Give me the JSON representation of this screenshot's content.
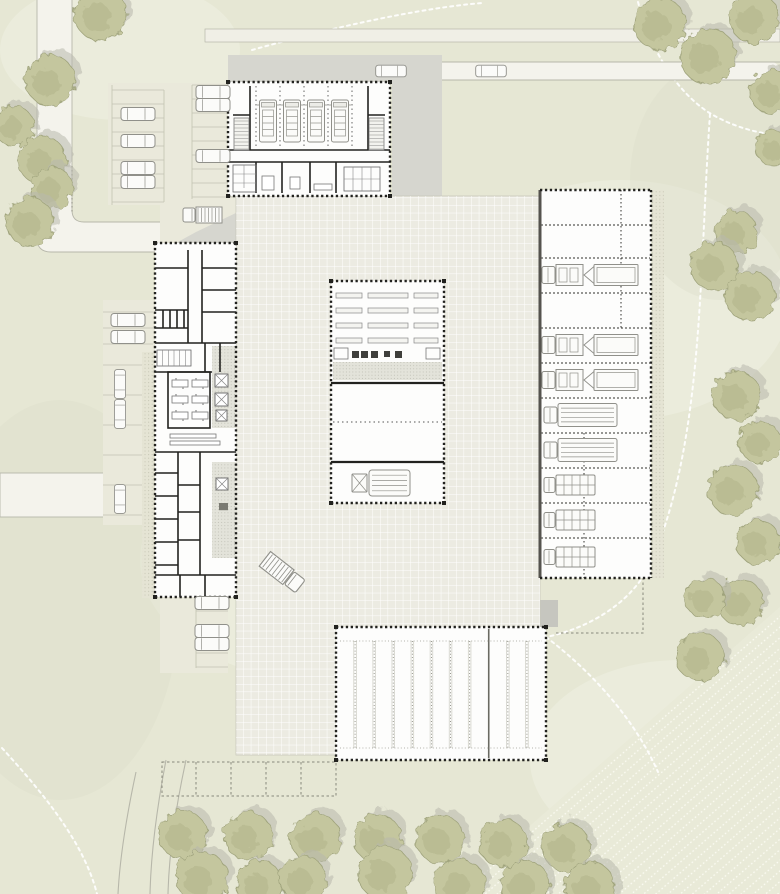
{
  "palette": {
    "grass": "#e6e7d4",
    "grass_light": "#eff0e1",
    "grass_dark": "#dcdecb",
    "field": "#e9ead8",
    "field_line": "#fbfbf2",
    "road": "#f4f3ec",
    "road_edge": "#b7b7aa",
    "top_band": "#f0efe6",
    "apron": "#d6d6cf",
    "shadow": "#c6c6bf",
    "courtyard": "#ecebe2",
    "grid_line": "#ffffff",
    "courtyard_edge": "#c8c8bb",
    "parking": "#eae9db",
    "stall_line": "#c2c2b2",
    "paver": "#e5e4d4",
    "paver_dot": "#c6c6b4",
    "building": "#fdfdfc",
    "wall": "#22221f",
    "wall_gray": "#55534e",
    "light_wall": "#d2d2c9",
    "hatch_floor": "#e3e3da",
    "hatch_dot": "#b5b5aa",
    "vehicle_stroke": "#90908a",
    "vehicle_fill": "#fbfbf9",
    "vehicle_detail": "#c9c9c2",
    "tree": "#c4c69e",
    "tree_dark": "#aeb187",
    "tree_edge": "#9fa37c",
    "tree_shadow": "#b9b9ad",
    "trail": "#ffffff",
    "dash_dark": "#88887c",
    "equip": "#3f3f3b"
  },
  "site": {
    "canvas": {
      "w": 780,
      "h": 894
    },
    "grass_patches_light": [
      [
        620,
        300,
        170,
        120
      ],
      [
        320,
        560,
        180,
        120
      ],
      [
        120,
        50,
        120,
        70
      ],
      [
        680,
        760,
        150,
        100
      ]
    ],
    "grass_patches_dark": [
      [
        60,
        600,
        120,
        200
      ],
      [
        720,
        180,
        90,
        120
      ]
    ],
    "roads": {
      "vertical_fill": "M37,0 L37,238 Q37,252 51,252 L162,252 L162,222 L84,222 Q72,222 72,210 L72,0 Z",
      "vertical_edges": [
        "M37,0 L37,238 Q37,252 51,252 L162,252",
        "M72,0 L72,210 Q72,222 84,222 L162,222"
      ],
      "curb_dots": "M72,166 L72,212",
      "top_band": [
        205,
        29,
        575,
        13
      ],
      "left_band": [
        0,
        473,
        112,
        44
      ],
      "lane": [
        358,
        62,
        422,
        18
      ],
      "lane_edges": [
        "M368,62 H780",
        "M368,80 H780",
        "M368,62 Q358,62 358,71 Q358,80 368,80"
      ],
      "curves": [
        "M166,760 C158,802 151,850 150,894",
        "M186,760 C176,806 169,852 168,894",
        "M136,772 C127,814 120,854 118,894"
      ]
    },
    "trails": [
      "M252,50 C330,28 420,8 482,3",
      "M638,2 C652,54 678,92 708,112 C732,127 760,134 780,135",
      "M710,114 C699,272 704,432 654,556",
      "M654,556 C634,606 582,630 546,637",
      "M546,637 C592,672 634,718 658,772",
      "M2,748 C42,792 84,842 97,894"
    ],
    "field_poly": "M452,894 L780,607 L780,894 Z",
    "trees": [
      [
        100,
        14,
        26
      ],
      [
        50,
        80,
        25
      ],
      [
        14,
        126,
        20
      ],
      [
        42,
        160,
        24
      ],
      [
        52,
        188,
        21
      ],
      [
        30,
        222,
        24
      ],
      [
        660,
        24,
        26
      ],
      [
        708,
        56,
        28
      ],
      [
        754,
        18,
        25
      ],
      [
        772,
        92,
        22
      ],
      [
        774,
        148,
        18
      ],
      [
        736,
        232,
        21
      ],
      [
        714,
        266,
        24
      ],
      [
        750,
        296,
        25
      ],
      [
        737,
        396,
        24
      ],
      [
        760,
        442,
        21
      ],
      [
        733,
        490,
        25
      ],
      [
        758,
        542,
        22
      ],
      [
        740,
        602,
        23
      ],
      [
        705,
        598,
        20
      ],
      [
        700,
        657,
        24
      ],
      [
        183,
        835,
        24
      ],
      [
        248,
        836,
        24
      ],
      [
        315,
        838,
        25
      ],
      [
        377,
        838,
        24
      ],
      [
        440,
        839,
        24
      ],
      [
        503,
        843,
        24
      ],
      [
        566,
        847,
        24
      ],
      [
        202,
        878,
        26
      ],
      [
        260,
        884,
        23
      ],
      [
        303,
        879,
        23
      ],
      [
        385,
        873,
        27
      ],
      [
        460,
        884,
        25
      ],
      [
        525,
        884,
        24
      ],
      [
        590,
        887,
        25
      ]
    ],
    "markings": {
      "dashed_stalls_outline": [
        162,
        762,
        174,
        34
      ],
      "dashed_stalls_verticals": [
        196,
        231,
        266,
        301
      ],
      "reserved": "M556,633 H643 V578"
    }
  },
  "parking": {
    "lotA": {
      "poly": "M108,83 H238 V243 H160 V205 H108 Z",
      "vlines": [
        [
          112,
          85,
          112,
          205
        ],
        [
          164,
          90,
          164,
          202
        ],
        [
          192,
          85,
          192,
          199
        ]
      ],
      "hlines_left": [
        90,
        104,
        118,
        132,
        146,
        160,
        174,
        188,
        202
      ],
      "hlines_right": [
        85,
        99,
        113,
        127,
        141,
        155,
        169,
        183,
        197
      ]
    },
    "lotB": {
      "poly": "M103,300 H155 V352 H142 V525 H103 Z",
      "hlines_top": [
        312,
        328,
        344
      ],
      "hlines": [
        365,
        395,
        425,
        455,
        485,
        515
      ]
    },
    "lotC": {
      "rect": [
        160,
        597,
        68,
        76
      ],
      "vline": [
        196,
        597,
        196,
        668
      ],
      "hlines": [
        597,
        611,
        625,
        639,
        653,
        667
      ]
    },
    "paver_strips": [
      [
        142,
        352,
        13,
        246
      ],
      [
        652,
        190,
        12,
        388
      ]
    ]
  },
  "aprons": {
    "north": "M228,55 H442 V197 H392 V82 H228 Z",
    "wedge": "M196,232 L238,212 L238,243 L176,243 Z",
    "canopy_shadow": "M345,627 L398,600 L558,600 L558,627 Z"
  },
  "courtyard": {
    "rect": [
      236,
      196,
      304,
      559
    ]
  },
  "buildings": {
    "hall": {
      "rect": [
        228,
        82,
        162,
        114
      ],
      "bays_dashed_x": [
        256,
        280,
        304,
        328,
        352
      ],
      "bay_top": 86,
      "bay_bottom": 149,
      "walls": [
        [
          250,
          86,
          250,
          150
        ],
        [
          233,
          115,
          250,
          115
        ],
        [
          368,
          86,
          368,
          150
        ],
        [
          368,
          115,
          385,
          115
        ],
        [
          228,
          150,
          390,
          150
        ],
        [
          228,
          162,
          390,
          162
        ],
        [
          256,
          162,
          256,
          193
        ],
        [
          282,
          162,
          282,
          193
        ],
        [
          310,
          162,
          310,
          193
        ],
        [
          336,
          162,
          336,
          193
        ]
      ],
      "stairs": [
        [
          234,
          118,
          15,
          32
        ],
        [
          369,
          118,
          15,
          32
        ]
      ],
      "closet": [
        233,
        165,
        23,
        27
      ],
      "lockers": [
        344,
        167,
        36,
        24
      ],
      "tables": [
        [
          262,
          176,
          12,
          14
        ],
        [
          290,
          177,
          10,
          12
        ],
        [
          314,
          184,
          18,
          6
        ]
      ],
      "trucks_cx": [
        268,
        292,
        316,
        340
      ],
      "trucks_cy": 121
    },
    "wing": {
      "rect": [
        155,
        243,
        81,
        354
      ],
      "walls": [
        [
          188,
          250,
          188,
          343
        ],
        [
          202,
          250,
          202,
          343
        ],
        [
          155,
          268,
          188,
          268
        ],
        [
          155,
          310,
          188,
          310
        ],
        [
          163,
          310,
          163,
          328
        ],
        [
          170,
          310,
          170,
          328
        ],
        [
          177,
          310,
          177,
          328
        ],
        [
          184,
          310,
          184,
          328
        ],
        [
          155,
          328,
          188,
          328
        ],
        [
          202,
          268,
          236,
          268
        ],
        [
          202,
          290,
          236,
          290
        ],
        [
          202,
          312,
          236,
          312
        ],
        [
          155,
          343,
          236,
          343
        ],
        [
          205,
          343,
          205,
          372
        ],
        [
          220,
          343,
          220,
          372
        ],
        [
          155,
          372,
          212,
          372
        ],
        [
          155,
          452,
          236,
          452
        ],
        [
          178,
          452,
          178,
          575
        ],
        [
          200,
          452,
          200,
          575
        ],
        [
          155,
          473,
          178,
          473
        ],
        [
          155,
          496,
          178,
          496
        ],
        [
          155,
          519,
          178,
          519
        ],
        [
          155,
          542,
          178,
          542
        ],
        [
          155,
          565,
          178,
          565
        ],
        [
          178,
          485,
          200,
          485
        ],
        [
          178,
          512,
          200,
          512
        ],
        [
          178,
          540,
          200,
          540
        ],
        [
          155,
          575,
          236,
          575
        ],
        [
          180,
          575,
          180,
          597
        ],
        [
          205,
          575,
          205,
          597
        ]
      ],
      "meeting_room": [
        168,
        372,
        42,
        56
      ],
      "tables": [
        [
          172,
          380,
          16,
          7
        ],
        [
          192,
          380,
          16,
          7
        ],
        [
          172,
          396,
          16,
          7
        ],
        [
          192,
          396,
          16,
          7
        ],
        [
          172,
          412,
          16,
          7
        ],
        [
          192,
          412,
          16,
          7
        ]
      ],
      "lockers": [
        157,
        350,
        34,
        16
      ],
      "benches": [
        [
          170,
          434,
          46,
          4
        ],
        [
          170,
          441,
          50,
          4
        ]
      ],
      "hatch_rects": [
        [
          212,
          346,
          24,
          82
        ],
        [
          212,
          462,
          24,
          96
        ]
      ],
      "fixtures": [
        [
          215,
          374,
          13
        ],
        [
          215,
          393,
          13
        ],
        [
          216,
          410,
          11
        ],
        [
          216,
          478,
          12
        ]
      ],
      "sink": [
        219,
        503,
        9
      ]
    },
    "workshop": {
      "rect": [
        331,
        281,
        113,
        222
      ],
      "solid_walls": [
        [
          331,
          383,
          444,
          383
        ],
        [
          331,
          462,
          444,
          462
        ]
      ],
      "shelf_rows": [
        293,
        308,
        323,
        338
      ],
      "shelf_cols": [
        [
          336,
          26
        ],
        [
          368,
          40
        ],
        [
          414,
          24
        ]
      ],
      "equip": [
        [
          352,
          351,
          7
        ],
        [
          361,
          351,
          7
        ],
        [
          371,
          351,
          7
        ],
        [
          384,
          351,
          6
        ],
        [
          395,
          351,
          7
        ]
      ],
      "benches": [
        [
          334,
          348,
          14,
          11
        ],
        [
          426,
          348,
          14,
          11
        ]
      ],
      "hatch": [
        333,
        362,
        109,
        18
      ],
      "dashed_lines": [
        [
          333,
          422,
          442,
          422
        ]
      ],
      "truck": [
        381,
        483
      ]
    },
    "garage": {
      "rect": [
        540,
        190,
        111,
        388
      ],
      "dividers_y": [
        225,
        258,
        293,
        328,
        363,
        398,
        433,
        468,
        503,
        538
      ],
      "vdash": [
        [
          621,
          190,
          621,
          328
        ],
        [
          584,
          433,
          584,
          578
        ]
      ],
      "bays": [
        {
          "cy": 275,
          "type": "ttrailer"
        },
        {
          "cy": 345,
          "type": "ttrailer"
        },
        {
          "cy": 380,
          "type": "ttrailer"
        },
        {
          "cy": 415,
          "type": "boxtruck"
        },
        {
          "cy": 450,
          "type": "boxtruck"
        },
        {
          "cy": 485,
          "type": "van"
        },
        {
          "cy": 520,
          "type": "van"
        },
        {
          "cy": 557,
          "type": "van"
        }
      ]
    },
    "canopy": {
      "rect": [
        336,
        627,
        210,
        133
      ],
      "stalls": 11,
      "solid_divider_index": 8,
      "stripe_top": 641,
      "stripe_bottom": 748
    }
  },
  "vehicles": [
    {
      "type": "car",
      "x": 138,
      "y": 114,
      "rot": 0
    },
    {
      "type": "car",
      "x": 138,
      "y": 141,
      "rot": 0
    },
    {
      "type": "car",
      "x": 138,
      "y": 168,
      "rot": 0
    },
    {
      "type": "car",
      "x": 138,
      "y": 182,
      "rot": 0
    },
    {
      "type": "car",
      "x": 213,
      "y": 92,
      "rot": 0
    },
    {
      "type": "car",
      "x": 213,
      "y": 105,
      "rot": 0
    },
    {
      "type": "car",
      "x": 213,
      "y": 156,
      "rot": 0
    },
    {
      "type": "car",
      "x": 391,
      "y": 71,
      "rot": 0,
      "s": 0.9
    },
    {
      "type": "car",
      "x": 491,
      "y": 71,
      "rot": 0,
      "s": 0.9
    },
    {
      "type": "car",
      "x": 128,
      "y": 320,
      "rot": 0
    },
    {
      "type": "car",
      "x": 128,
      "y": 337,
      "rot": 0
    },
    {
      "type": "car",
      "x": 120,
      "y": 384,
      "rot": 90,
      "s": 0.85
    },
    {
      "type": "car",
      "x": 120,
      "y": 414,
      "rot": 90,
      "s": 0.85
    },
    {
      "type": "car",
      "x": 120,
      "y": 499,
      "rot": 90,
      "s": 0.85
    },
    {
      "type": "car",
      "x": 212,
      "y": 603,
      "rot": 0
    },
    {
      "type": "car",
      "x": 212,
      "y": 631,
      "rot": 0
    },
    {
      "type": "car",
      "x": 212,
      "y": 644,
      "rot": 0
    },
    {
      "type": "btruck",
      "x": 202,
      "y": 215,
      "rot": 180
    },
    {
      "type": "btruck",
      "x": 283,
      "y": 573,
      "rot": 38,
      "s": 1.15
    }
  ]
}
